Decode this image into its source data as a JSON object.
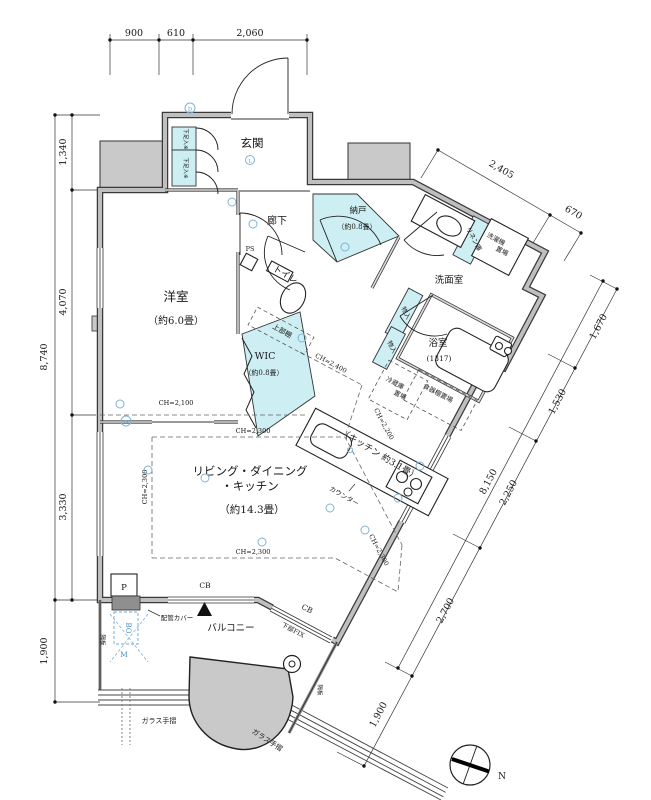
{
  "colors": {
    "accent_cyan": "#cdeef3",
    "wall_gray": "#c9c9c9",
    "symbol_blue": "#6aa7d8"
  },
  "dims": {
    "top": [
      "900",
      "610",
      "2,060"
    ],
    "left_total": "8,740",
    "left_segs": [
      "1,340",
      "4,070",
      "3,330"
    ],
    "left_bottom": "1,900",
    "top_right": [
      "2,405",
      "670"
    ],
    "right_total": "8,150",
    "right_segs": [
      "1,670",
      "1,530",
      "2,250",
      "2,700"
    ],
    "right_bottom": "1,900"
  },
  "rooms": {
    "genkan": "玄関",
    "rouka": "廊下",
    "nando": "納戸",
    "nando_size": "（約0.8畳）",
    "yoshitsu": "洋室",
    "yoshitsu_size": "（約6.0畳）",
    "toilet": "トイレ",
    "wic": "WIC",
    "wic_size": "（約0.8畳）",
    "senmen": "洗面室",
    "yokushitsu": "浴室",
    "yokushitsu_size": "(1317)",
    "ldk_line1": "リビング・ダイニング",
    "ldk_line2": "・キッチン",
    "ldk_size": "（約14.3畳）",
    "kitchen": "（キッチン 約3.1畳）",
    "balcony": "バルコニー"
  },
  "storage": {
    "jyoubudana": "上部棚",
    "linen": "リネン庫",
    "sentaku_l1": "洗濯機",
    "sentaku_l2": "置場",
    "monoire1": "物入",
    "monoire2": "物入",
    "reizo_l1": "冷蔵庫",
    "reizo_l2": "置場",
    "shokki": "食器棚置場",
    "gesoku1": "下足入※",
    "gesoku2": "下足入※",
    "counter": "カウンター"
  },
  "annotations": {
    "ps": "PS",
    "p": "P",
    "bo": "BO",
    "m": "M",
    "cb1": "CB",
    "cb2": "CB",
    "kabufix": "下部FIX",
    "haikan": "配管カバー",
    "kakuita1": "隔板",
    "kakuita2": "隔板",
    "glass1": "ガラス手摺",
    "glass2": "ガラス手摺",
    "ch_yoshitsu": "CH=2,100",
    "ch_ldk_top": "CH=2,300",
    "ch_ldk_bottom": "CH=2,300",
    "ch_ldk_left": "CH=2,300",
    "ch_ldk_right": "CH=2,300",
    "ch_kitchen": "CH=2,400",
    "ch_kitchen2": "CH=2,200",
    "north": "N",
    "tv": "TV",
    "d": "D",
    "l": "L"
  }
}
